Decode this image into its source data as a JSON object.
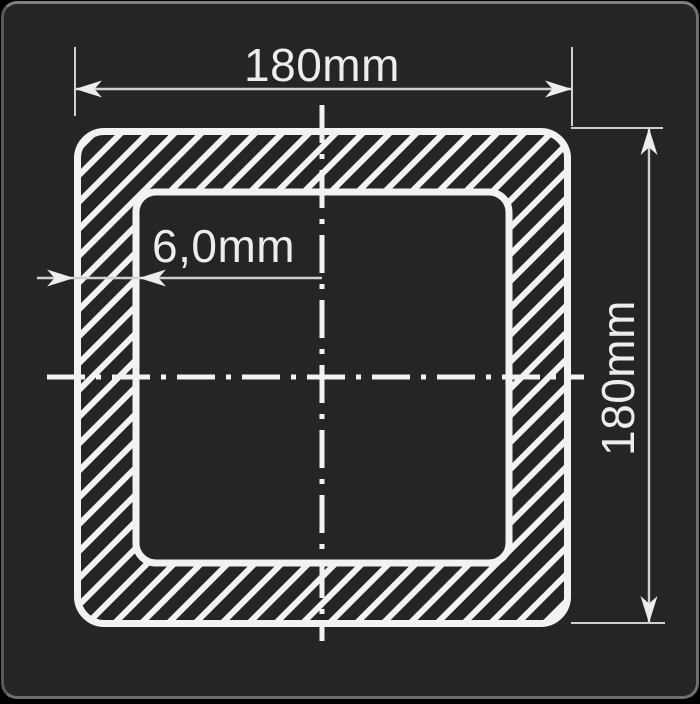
{
  "colors": {
    "page_bg": "#000000",
    "canvas_bg": "#252526",
    "canvas_border": "#6f6f6f",
    "stroke": "#f2f2f2",
    "dim_line": "#cfcfcf",
    "text": "#ededed"
  },
  "drawing": {
    "labels": {
      "width": "180mm",
      "height": "180mm",
      "thickness": "6,0mm"
    }
  }
}
